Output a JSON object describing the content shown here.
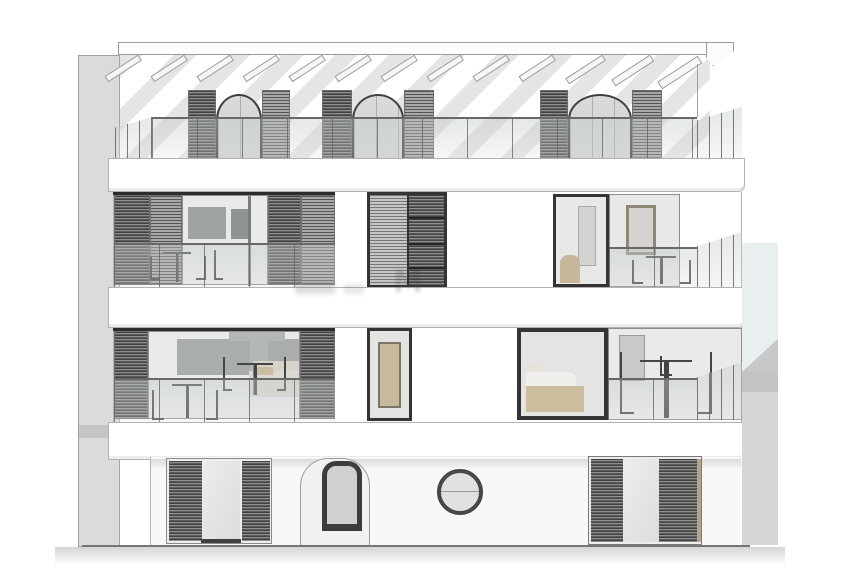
{
  "meta": {
    "title": "Building front elevation (architectural drawing)",
    "drawing_type": "elevation",
    "levels": 4
  },
  "palette": {
    "paper": "#ffffff",
    "side_wall": "#dbdbdb",
    "stripe": "#e5e5e5",
    "line": "#a9a9a9",
    "frame_dark": "#343434",
    "interior": "#e9eaea",
    "interior_grey": "#a2a7a7",
    "accent_tan": "#c7b79c",
    "adjacent_sky": "#e9eef1",
    "adjacent_band": "#c2c3c5",
    "adjacent_wall": "#d5d6d8",
    "ground_line": "#757575",
    "pavement": "#d6d6d6"
  },
  "watermark": {
    "text": "M"
  },
  "structure": {
    "pergola": {
      "rafters": 13
    },
    "roof_terrace": {
      "arched_dormers": 3,
      "shutters_per_dormer": 2,
      "balustrade": "glass"
    },
    "floor_2": {
      "louvered_panels": 6,
      "dark_framed_windows": 2,
      "balconies_with_furniture": 2
    },
    "floor_1": {
      "louvered_panels": 2,
      "dark_framed_windows": 2,
      "balconies_with_furniture": 2,
      "bedroom_bed_visible": 1
    },
    "ground_floor": {
      "shuttered_windows": 2,
      "arched_door": 1,
      "round_window": 1
    }
  }
}
